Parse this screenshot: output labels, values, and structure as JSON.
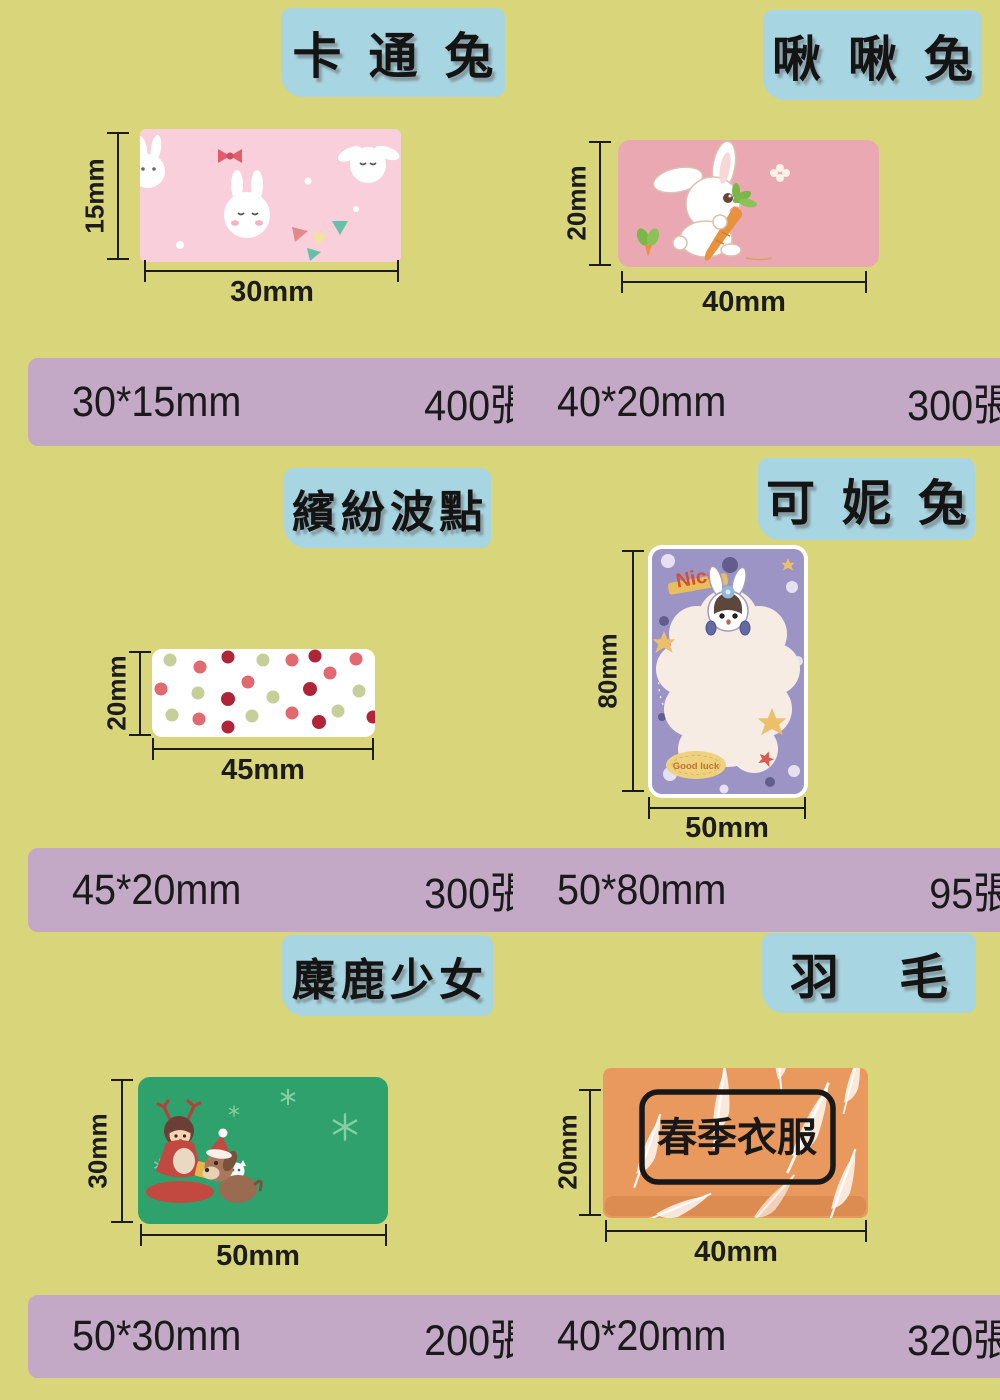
{
  "page": {
    "background_color": "#d8d57b",
    "title_box_color": "#a7d5e1",
    "spec_bar_color": "#c4a9c6",
    "ink_color": "#1c1c1c"
  },
  "products": [
    {
      "name": "卡通兔",
      "height_label": "15mm",
      "width_label": "30mm",
      "size": "30*15mm",
      "quantity": "400張",
      "label_color": "#f8cfdb"
    },
    {
      "name": "啾啾兔",
      "height_label": "20mm",
      "width_label": "40mm",
      "size": "40*20mm",
      "quantity": "300張",
      "label_color": "#e9a8b2"
    },
    {
      "name": "繽紛波點",
      "height_label": "20mm",
      "width_label": "45mm",
      "size": "45*20mm",
      "quantity": "300張",
      "label_color": "#ffffff"
    },
    {
      "name": "可妮兔",
      "height_label": "80mm",
      "width_label": "50mm",
      "size": "50*80mm",
      "quantity": "95張",
      "label_color": "#9b94c4",
      "texts": {
        "nice": "Nice",
        "good_luck": "Good luck"
      }
    },
    {
      "name": "麋鹿少女",
      "height_label": "30mm",
      "width_label": "50mm",
      "size": "50*30mm",
      "quantity": "200張",
      "label_color": "#2ea16c"
    },
    {
      "name": "羽毛",
      "height_label": "20mm",
      "width_label": "40mm",
      "size": "40*20mm",
      "quantity": "320張",
      "label_color": "#e9995d",
      "texts": {
        "tag": "春季衣服"
      }
    }
  ]
}
